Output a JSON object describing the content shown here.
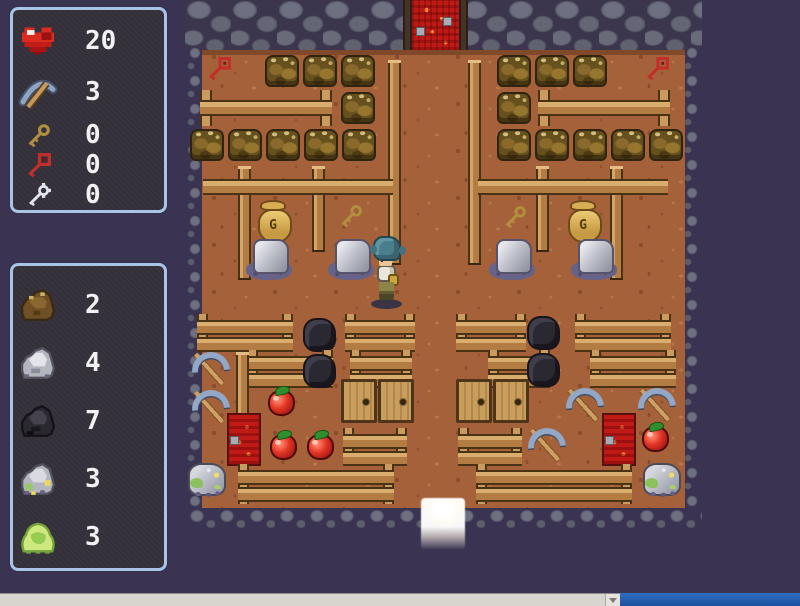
{
  "hud": {
    "stats_panel": {
      "items": [
        {
          "icon": "heart-icon",
          "value": "20"
        },
        {
          "icon": "pickaxe-icon",
          "value": "3"
        },
        {
          "icon": "gold-key-icon",
          "value": "0"
        },
        {
          "icon": "red-key-icon",
          "value": "0"
        },
        {
          "icon": "silver-key-icon",
          "value": "0"
        }
      ]
    },
    "inventory_panel": {
      "items": [
        {
          "icon": "brown-ore-icon",
          "value": "2"
        },
        {
          "icon": "gray-ore-icon",
          "value": "4"
        },
        {
          "icon": "coal-ore-icon",
          "value": "7"
        },
        {
          "icon": "sparkle-ore-icon",
          "value": "3"
        },
        {
          "icon": "slime-icon",
          "value": "3"
        }
      ]
    }
  },
  "map": {
    "moneybag_label": "G",
    "entities": [
      {
        "t": "door-red",
        "x": 412,
        "y": 0
      },
      {
        "t": "doorpost",
        "x": 403,
        "y": 0
      },
      {
        "t": "doorpost",
        "x": 459,
        "y": 0
      },
      {
        "t": "key-red",
        "x": 204,
        "y": 56
      },
      {
        "t": "key-red",
        "x": 642,
        "y": 56
      },
      {
        "t": "crate",
        "x": 265,
        "y": 55
      },
      {
        "t": "crate",
        "x": 303,
        "y": 55
      },
      {
        "t": "crate",
        "x": 341,
        "y": 55
      },
      {
        "t": "crate",
        "x": 497,
        "y": 55
      },
      {
        "t": "crate",
        "x": 535,
        "y": 55
      },
      {
        "t": "crate",
        "x": 573,
        "y": 55
      },
      {
        "t": "fence",
        "x": 200,
        "y": 90,
        "w": 132
      },
      {
        "t": "fence",
        "x": 538,
        "y": 90,
        "w": 132
      },
      {
        "t": "crate",
        "x": 341,
        "y": 92
      },
      {
        "t": "crate",
        "x": 497,
        "y": 92
      },
      {
        "t": "post",
        "x": 388,
        "y": 60,
        "h": 205
      },
      {
        "t": "post",
        "x": 468,
        "y": 60,
        "h": 205
      },
      {
        "t": "crate",
        "x": 190,
        "y": 129
      },
      {
        "t": "crate",
        "x": 228,
        "y": 129
      },
      {
        "t": "crate",
        "x": 266,
        "y": 129
      },
      {
        "t": "crate",
        "x": 304,
        "y": 129
      },
      {
        "t": "crate",
        "x": 342,
        "y": 129
      },
      {
        "t": "crate",
        "x": 497,
        "y": 129
      },
      {
        "t": "crate",
        "x": 535,
        "y": 129
      },
      {
        "t": "crate",
        "x": 573,
        "y": 129
      },
      {
        "t": "crate",
        "x": 611,
        "y": 129
      },
      {
        "t": "crate",
        "x": 649,
        "y": 129
      },
      {
        "t": "post",
        "x": 238,
        "y": 166,
        "h": 114
      },
      {
        "t": "post",
        "x": 312,
        "y": 166,
        "h": 86
      },
      {
        "t": "post",
        "x": 536,
        "y": 166,
        "h": 86
      },
      {
        "t": "post",
        "x": 610,
        "y": 166,
        "h": 114
      },
      {
        "t": "rail",
        "x": 203,
        "y": 179,
        "w": 190
      },
      {
        "t": "rail",
        "x": 478,
        "y": 179,
        "w": 190
      },
      {
        "t": "moneybag",
        "x": 256,
        "y": 200
      },
      {
        "t": "key-gold",
        "x": 336,
        "y": 203
      },
      {
        "t": "key-gold",
        "x": 500,
        "y": 204
      },
      {
        "t": "moneybag",
        "x": 566,
        "y": 200
      },
      {
        "t": "rock-gray",
        "x": 245,
        "y": 238
      },
      {
        "t": "rock-gray",
        "x": 327,
        "y": 238
      },
      {
        "t": "rock-gray",
        "x": 488,
        "y": 238
      },
      {
        "t": "rock-gray",
        "x": 570,
        "y": 238
      },
      {
        "t": "bench",
        "x": 197,
        "y": 314,
        "w": 96
      },
      {
        "t": "bench",
        "x": 345,
        "y": 314,
        "w": 70
      },
      {
        "t": "bench",
        "x": 456,
        "y": 314,
        "w": 70
      },
      {
        "t": "bench",
        "x": 575,
        "y": 314,
        "w": 96
      },
      {
        "t": "rock-coal",
        "x": 303,
        "y": 318
      },
      {
        "t": "rock-coal",
        "x": 527,
        "y": 316
      },
      {
        "t": "bench",
        "x": 247,
        "y": 350,
        "w": 86
      },
      {
        "t": "bench",
        "x": 350,
        "y": 350,
        "w": 62
      },
      {
        "t": "bench",
        "x": 488,
        "y": 350,
        "w": 62
      },
      {
        "t": "bench",
        "x": 590,
        "y": 350,
        "w": 86
      },
      {
        "t": "post",
        "x": 236,
        "y": 352,
        "h": 112
      },
      {
        "t": "rock-coal",
        "x": 303,
        "y": 354
      },
      {
        "t": "rock-coal",
        "x": 527,
        "y": 353
      },
      {
        "t": "pickaxe",
        "x": 190,
        "y": 350
      },
      {
        "t": "pickaxe",
        "x": 190,
        "y": 388
      },
      {
        "t": "apple",
        "x": 268,
        "y": 390
      },
      {
        "t": "pickaxe",
        "x": 564,
        "y": 386
      },
      {
        "t": "pickaxe",
        "x": 636,
        "y": 386
      },
      {
        "t": "cabinet",
        "x": 341,
        "y": 379
      },
      {
        "t": "cabinet",
        "x": 378,
        "y": 379
      },
      {
        "t": "cabinet",
        "x": 456,
        "y": 379
      },
      {
        "t": "cabinet",
        "x": 493,
        "y": 379
      },
      {
        "t": "door-red-sm",
        "x": 227,
        "y": 413
      },
      {
        "t": "door-red-sm",
        "x": 602,
        "y": 413
      },
      {
        "t": "apple",
        "x": 270,
        "y": 434
      },
      {
        "t": "apple",
        "x": 307,
        "y": 434
      },
      {
        "t": "pickaxe",
        "x": 526,
        "y": 426
      },
      {
        "t": "apple",
        "x": 642,
        "y": 426
      },
      {
        "t": "bench",
        "x": 343,
        "y": 428,
        "w": 64
      },
      {
        "t": "bench",
        "x": 458,
        "y": 428,
        "w": 64
      },
      {
        "t": "rock-sparkle",
        "x": 188,
        "y": 463
      },
      {
        "t": "rock-sparkle",
        "x": 643,
        "y": 463
      },
      {
        "t": "bench2",
        "x": 238,
        "y": 464,
        "w": 156
      },
      {
        "t": "bench2",
        "x": 476,
        "y": 464,
        "w": 156
      },
      {
        "t": "player",
        "x": 370,
        "y": 236
      },
      {
        "t": "exit-light",
        "x": 421,
        "y": 498
      }
    ]
  },
  "colors": {
    "background": "#3a3452",
    "panel_border": "#a9c4e4",
    "panel_bg": "#333039",
    "dirt": "#a5613a",
    "wall_rock": "#6e7082",
    "wood": "#c6955c",
    "taskbar_blue": "#1c55a8"
  }
}
